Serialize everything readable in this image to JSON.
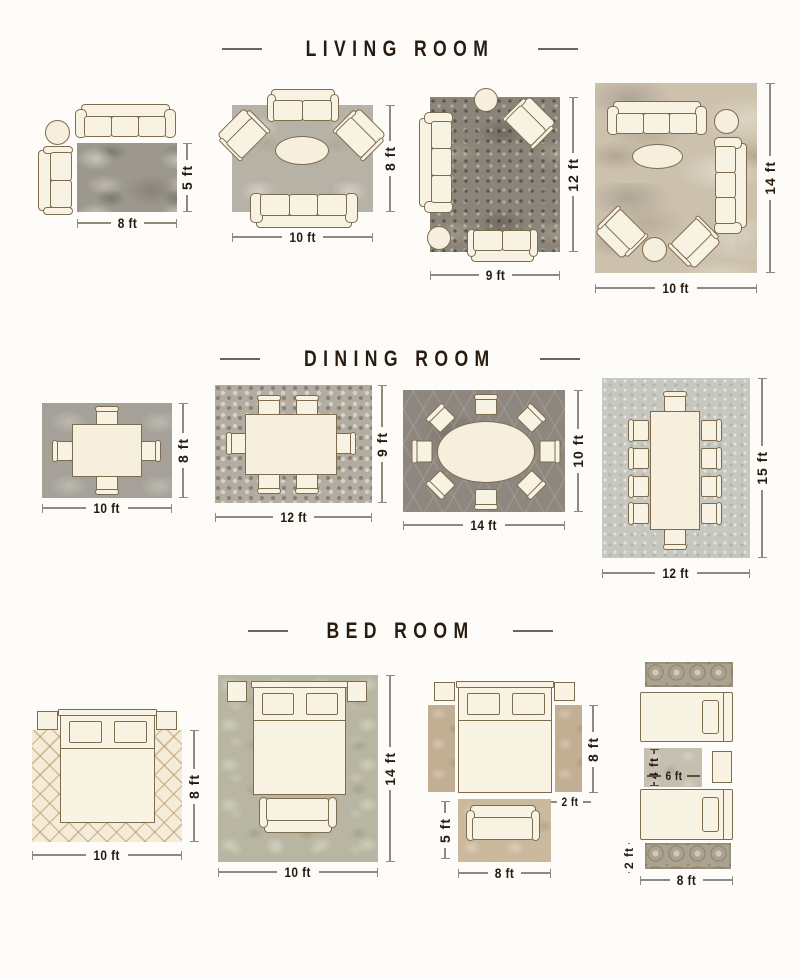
{
  "colors": {
    "background": "#fdfcf9",
    "title_text": "#281c11",
    "dimension_text": "#26190e",
    "dimension_line": "#91897f",
    "furniture_fill": "#f8f2e3",
    "furniture_outline": "#7e6c4e"
  },
  "sections": [
    {
      "title": "LIVING ROOM",
      "layouts": [
        {
          "width": "8 ft",
          "height": "5 ft"
        },
        {
          "width": "10 ft",
          "height": "8 ft"
        },
        {
          "width": "9 ft",
          "height": "12 ft"
        },
        {
          "width": "10 ft",
          "height": "14 ft"
        }
      ]
    },
    {
      "title": "DINING ROOM",
      "layouts": [
        {
          "width": "10 ft",
          "height": "8 ft"
        },
        {
          "width": "12 ft",
          "height": "9 ft"
        },
        {
          "width": "14 ft",
          "height": "10 ft"
        },
        {
          "width": "12 ft",
          "height": "15 ft"
        }
      ]
    },
    {
      "title": "BED ROOM",
      "layouts": [
        {
          "width": "10 ft",
          "height": "8 ft"
        },
        {
          "width": "10 ft",
          "height": "14 ft"
        },
        {
          "runner_height": "8 ft",
          "runner_width": "2 ft",
          "rug_width": "8 ft",
          "rug_height": "5 ft"
        },
        {
          "rug_height": "4 ft",
          "rug_width": "6 ft",
          "runner_height": "2 ft",
          "row_width": "8 ft"
        }
      ]
    }
  ]
}
